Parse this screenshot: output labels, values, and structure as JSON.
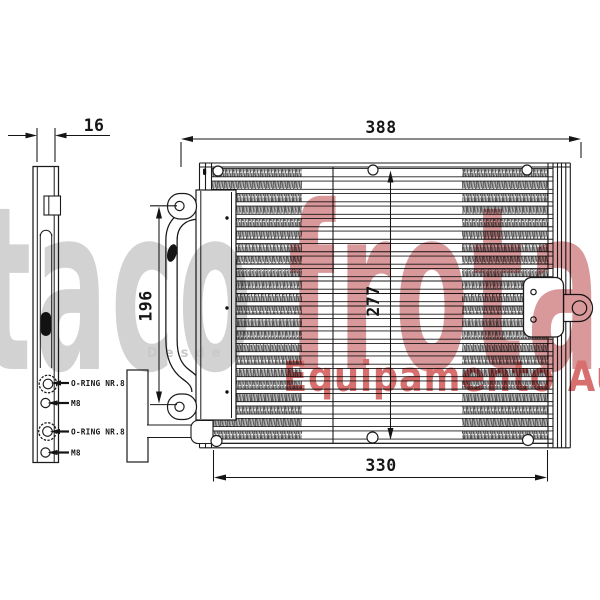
{
  "watermark": {
    "brand_gray": "taco",
    "brand_red": "frota",
    "small_text": "Desde",
    "tagline": "Equipamento Auto",
    "colors": {
      "gray": "#d2d2d2",
      "red": "#d9999b",
      "tagline_red": "#d76f6f"
    }
  },
  "drawing": {
    "line_color": "#1b1b1b",
    "background": "#ffffff",
    "dimensions": {
      "side_depth": "16",
      "overall_width": "388",
      "left_pipe_height": "196",
      "core_height": "277",
      "core_width": "330"
    },
    "port_labels": [
      {
        "label": "O-RING NR.8"
      },
      {
        "label": "M8"
      },
      {
        "label": "O-RING NR.8"
      },
      {
        "label": "M8"
      }
    ]
  }
}
